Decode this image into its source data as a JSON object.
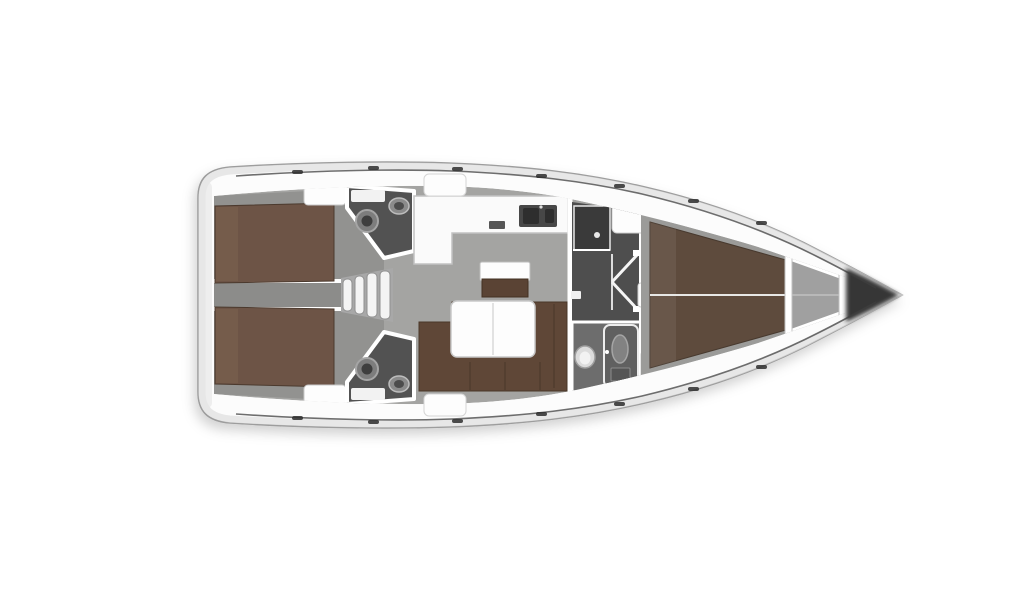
{
  "scene": {
    "type": "sailing-yacht-floorplan-top-view",
    "orientation": "bow-right",
    "background": "#ffffff"
  },
  "colors": {
    "hull": "#fcfcfc",
    "hull_stroke": "#9d9d9d",
    "inner_rim": "#dedede",
    "sheer_line": "#3f3f3f",
    "saloon_floor": "#a4a4a2",
    "cabin_floor": "#929290",
    "corridor_floor": "#8c8c8a",
    "steps_base": "#a8a8a8",
    "tread_white": "#f4f4f4",
    "head_floor": "#525252",
    "passage_floor": "#4e4e4e",
    "shower_room_floor": "#6d6d6d",
    "fwd_cabin_floor": "#9b9b99",
    "anchor_locker": "#a0a0a0",
    "bed_aft": "#6d5446",
    "bed_fwd": "#5e4b3d",
    "sofa": "#5f4737",
    "sofa_stroke": "#4a3728",
    "cabinet_brown": "#5a4334",
    "furniture_white": "#fdfdfd",
    "furniture_stroke": "#c9c9c9",
    "counter_white": "#fafafa",
    "sink_dark": "#474747",
    "basin_dark": "#2e2e2e",
    "wall_white": "#ffffff",
    "bow_dark": "#262626",
    "fixture_gray": "#7d7d7d",
    "fixture_dark": "#3e3e3e",
    "toilet_white": "#dcdcdc",
    "wardrobe_dark": "#3a3a3a",
    "shower_panel": "#606060"
  },
  "rooms": [
    {
      "id": "aft-cabin-port",
      "label": "Aft double cabin (port)"
    },
    {
      "id": "aft-cabin-starboard",
      "label": "Aft double cabin (starboard)"
    },
    {
      "id": "aft-head-port",
      "label": "Aft head with toilet and basin (port)"
    },
    {
      "id": "aft-head-starboard",
      "label": "Aft head with toilet and basin (starboard)"
    },
    {
      "id": "companionway",
      "label": "Companionway steps"
    },
    {
      "id": "saloon",
      "label": "Saloon with U-sofa and folding table"
    },
    {
      "id": "galley",
      "label": "L-shaped galley with twin sink"
    },
    {
      "id": "forward-passage",
      "label": "Forward passage with wardrobe and doors"
    },
    {
      "id": "forward-head",
      "label": "Forward head with shower and toilet"
    },
    {
      "id": "forward-cabin",
      "label": "Forward V-berth cabin"
    },
    {
      "id": "anchor-locker",
      "label": "Anchor locker"
    },
    {
      "id": "bow",
      "label": "Bow tip"
    }
  ]
}
